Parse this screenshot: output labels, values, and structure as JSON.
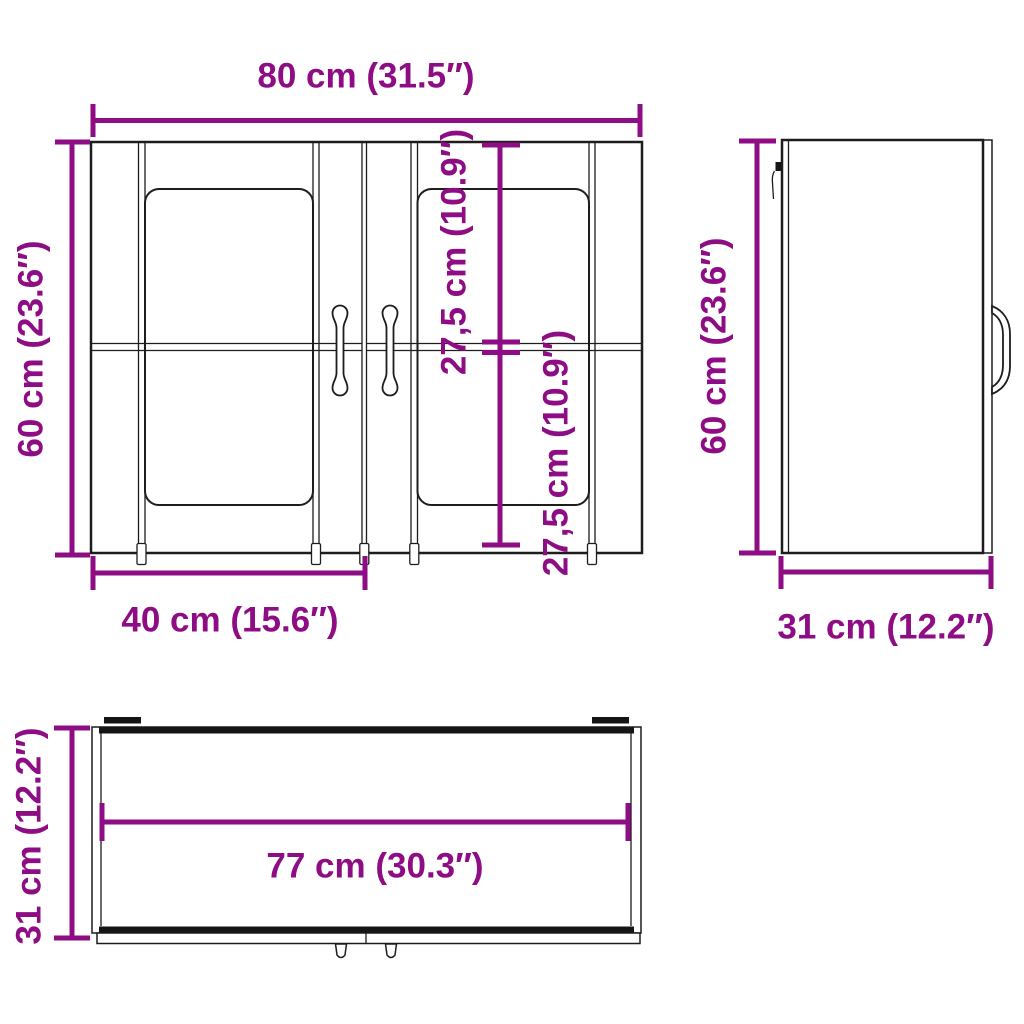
{
  "colors": {
    "dimension_accent": "#8E0C84",
    "drawing_line": "#1d1d1d",
    "background": "#ffffff"
  },
  "front_view": {
    "width_label": "80 cm (31.5″)",
    "height_label": "60 cm (23.6″)",
    "door_width_label": "40 cm (15.6″)",
    "upper_glass_label": "27,5 cm (10.9″)",
    "lower_glass_label": "27,5 cm (10.9″)"
  },
  "side_view": {
    "height_label": "60 cm (23.6″)",
    "depth_label": "31 cm (12.2″)"
  },
  "top_view": {
    "inner_width_label": "77 cm (30.3″)",
    "depth_label": "31 cm (12.2″)"
  }
}
